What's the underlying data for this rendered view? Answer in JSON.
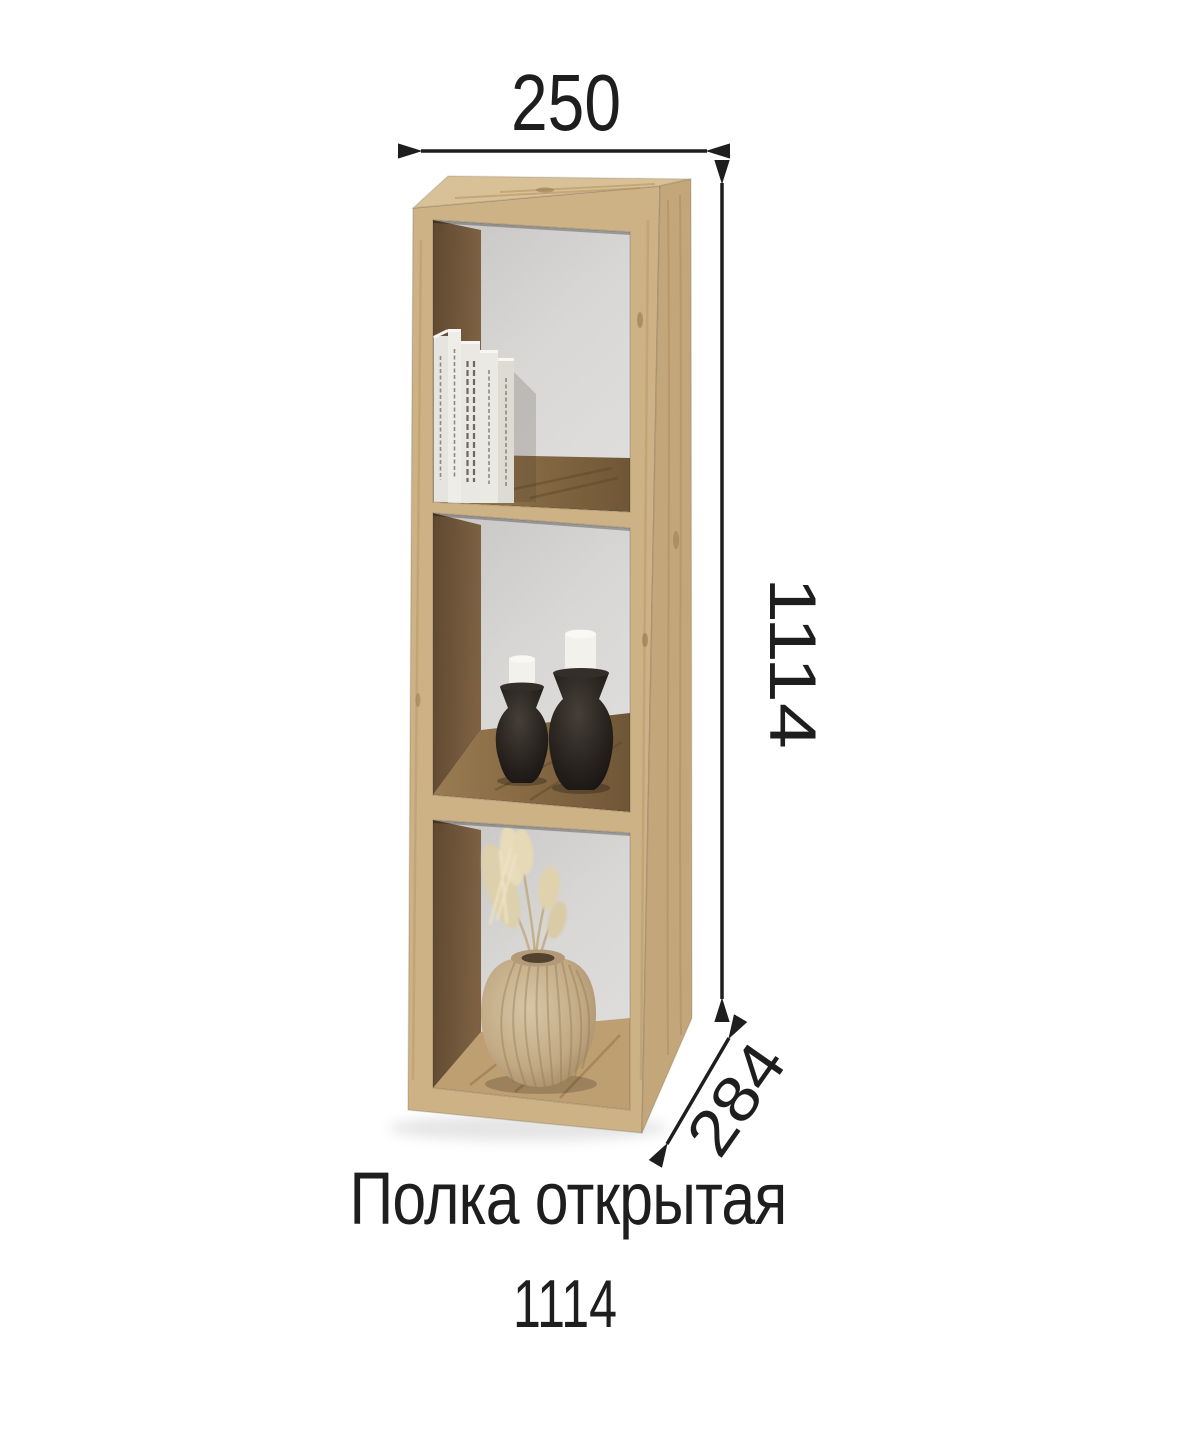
{
  "product": {
    "title": "Полка открытая",
    "code": "1114"
  },
  "dimensions": {
    "width": "250",
    "height": "1114",
    "depth": "284"
  },
  "colors": {
    "background": "#ffffff",
    "annotation": "#1e1e1e",
    "wood_front": "#cdb286",
    "wood_top": "#d9c197",
    "wood_side": "#c3a77a",
    "wood_inner_shadow": "#6d5438",
    "wood_shelf_top": "#97774b",
    "wood_floor": "#bd9f72",
    "back_panel": "#d6d5d3",
    "book_spine": "#eae8e2",
    "candle": "#f3f1eb",
    "candle_holder": "#221e1a",
    "vase": "#c8b292",
    "dried_grass": "#ddd0ac"
  }
}
